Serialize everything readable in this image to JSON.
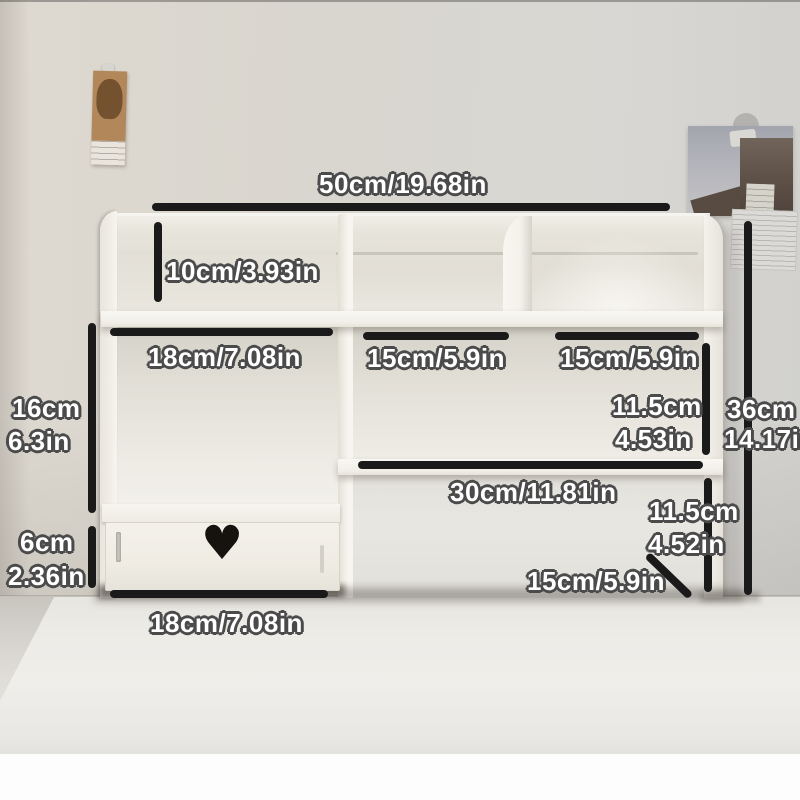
{
  "meta": {
    "description": "Product photo of a cream desktop bookshelf organizer with drawer, annotated with dimension lines"
  },
  "colors": {
    "annotation_line": "#1a1a1a",
    "label_text": "#ffffff",
    "label_outline": "#4b4b4b",
    "furniture": "#f2efe7",
    "wall": "#d8d5ce",
    "desk": "#edebe6"
  },
  "icons": {
    "heart_cutout": "♥"
  },
  "labels": {
    "top_width": "50cm/19.68in",
    "top_left_cubby_height": "10cm/3.93in",
    "left_section_width": "18cm/7.08in",
    "middle_section_width": "15cm/5.9in",
    "right_section_width": "15cm/5.9in",
    "upper_right_height_cm": "11.5cm",
    "upper_right_height_in": "4.53in",
    "overall_height_cm": "36cm",
    "overall_height_in": "14.17in",
    "left_opening_height_cm": "16cm",
    "left_opening_height_in": "6.3in",
    "lower_shelf_width": "30cm/11.81in",
    "lower_right_height_cm": "11.5cm",
    "lower_right_height_in": "4.52in",
    "drawer_height_cm": "6cm",
    "drawer_height_in": "2.36in",
    "base_right_width": "15cm/5.9in",
    "drawer_width": "18cm/7.08in"
  }
}
